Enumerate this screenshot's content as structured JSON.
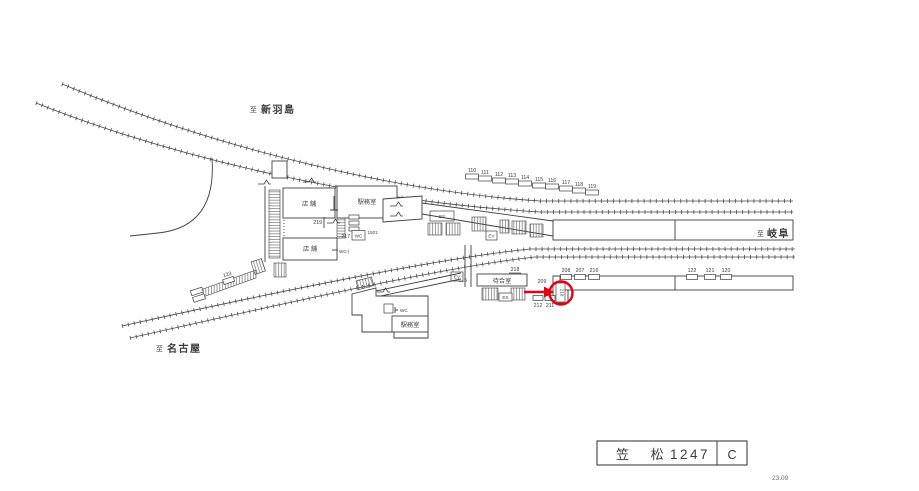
{
  "colors": {
    "ink": "#3f3f3f",
    "highlight_red": "#e60012",
    "paper": "#ffffff"
  },
  "destinations": {
    "hashima": {
      "prefix": "至",
      "name": "新羽島"
    },
    "gifu": {
      "prefix": "至",
      "name": "岐阜"
    },
    "nagoya": {
      "prefix": "至",
      "name": "名古屋"
    }
  },
  "rooms": {
    "shop_upper": "店 舗",
    "office_upper": "駅務室",
    "shop_lower": "店 舗",
    "office_lower": "駅務室",
    "waiting_room": "待合室",
    "wc_upper": "WC",
    "wc_mid": "WC-|",
    "wc_lower": "WC",
    "es_bridge": "ES",
    "es_platform": "ES",
    "ev_bridge": "EV",
    "ev_platform": "EV"
  },
  "numbers": {
    "upper_row": [
      "110",
      "111",
      "112",
      "113",
      "114",
      "115",
      "116",
      "117",
      "118",
      "119"
    ],
    "group_left": [
      "208",
      "207",
      "216"
    ],
    "group_right": [
      "122",
      "121",
      "120"
    ],
    "n212": "212",
    "n211": "211",
    "n209": "209",
    "n210_circled": "210",
    "n218": "218",
    "n215": "215",
    "n219": "219",
    "n217": "217",
    "n1501": "1501",
    "n123": "123"
  },
  "title_block": {
    "station": "笠 松",
    "sheet": "1247",
    "grade": "C"
  },
  "revision": "23.09"
}
